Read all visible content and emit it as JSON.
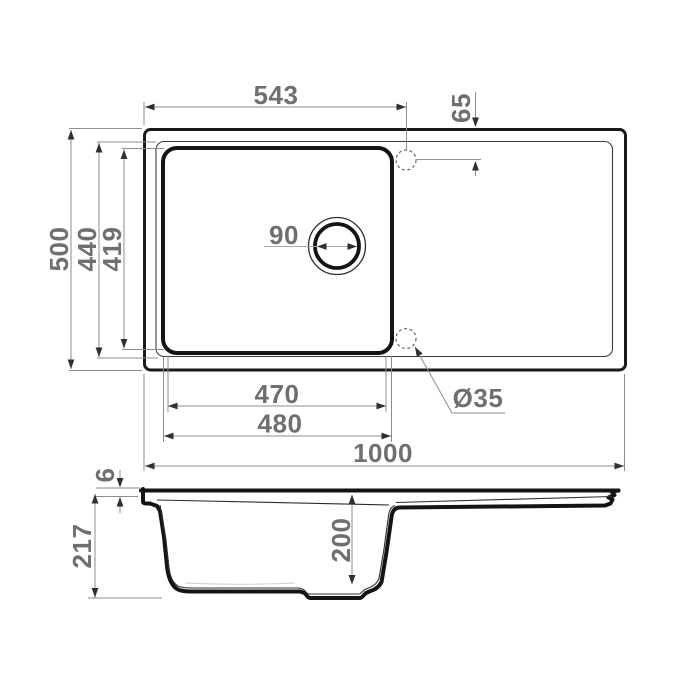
{
  "drawing": {
    "kind": "sink-technical-dimension-drawing",
    "views": [
      {
        "id": "plan",
        "label": "top view"
      },
      {
        "id": "section",
        "label": "side section view"
      }
    ]
  },
  "dimensions": {
    "plan": {
      "tap_hole_center_from_left_edge": "543",
      "tap_hole_center_from_top_edge": "65",
      "overall_depth": "500",
      "rim_inner_depth": "440",
      "bowl_inner_depth": "419",
      "drain_opening_diameter": "90",
      "bowl_inner_width": "470",
      "bowl_outer_width": "480",
      "overall_width": "1000",
      "tap_hole_diameter": "Ø35"
    },
    "section": {
      "rim_thickness": "6",
      "overall_height": "217",
      "bowl_depth": "200"
    }
  },
  "colors": {
    "background": "#ffffff",
    "part_outline": "#1a1a1a",
    "dimension_line": "#8c8c8c",
    "dimension_text": "#6f6f6f"
  }
}
